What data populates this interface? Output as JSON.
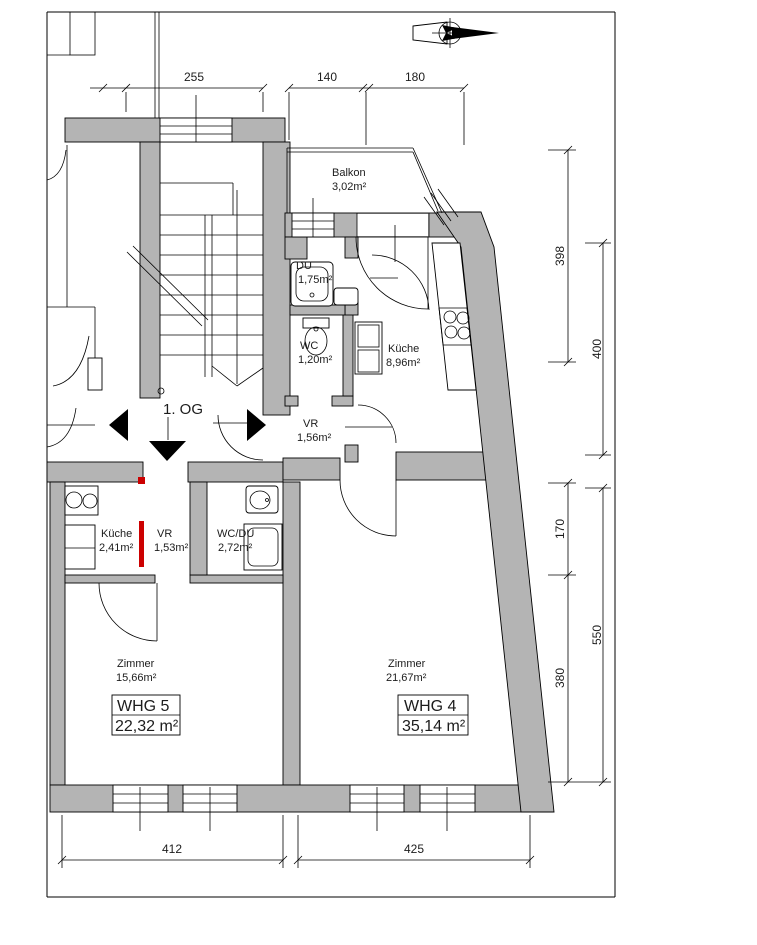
{
  "floor_label": "1. OG",
  "rooms": {
    "balkon": {
      "name": "Balkon",
      "area": "3,02m²"
    },
    "du4": {
      "name": "DU",
      "area": "1,75m²"
    },
    "wc4": {
      "name": "WC",
      "area": "1,20m²"
    },
    "kueche4": {
      "name": "Küche",
      "area": "8,96m²"
    },
    "vr4": {
      "name": "VR",
      "area": "1,56m²"
    },
    "kueche5": {
      "name": "Küche",
      "area": "2,41m²"
    },
    "vr5": {
      "name": "VR",
      "area": "1,53m²"
    },
    "wcdu5": {
      "name": "WC/DU",
      "area": "2,72m²"
    },
    "zimmer5": {
      "name": "Zimmer",
      "area": "15,66m²"
    },
    "zimmer4": {
      "name": "Zimmer",
      "area": "21,67m²"
    }
  },
  "apartments": {
    "whg5": {
      "label": "WHG 5",
      "total_area": "22,32 m²"
    },
    "whg4": {
      "label": "WHG 4",
      "total_area": "35,14 m²"
    }
  },
  "dimensions": {
    "top": {
      "d1": "255",
      "d2": "140",
      "d3": "180"
    },
    "right": {
      "d398": "398",
      "d400": "400",
      "d170": "170",
      "d550": "550",
      "d380": "380"
    },
    "bottom": {
      "d412": "412",
      "d425": "425"
    }
  },
  "colors": {
    "wall": "#b4b4b4",
    "line": "#000000",
    "new_construction_red": "#cc0000",
    "background": "#ffffff"
  }
}
